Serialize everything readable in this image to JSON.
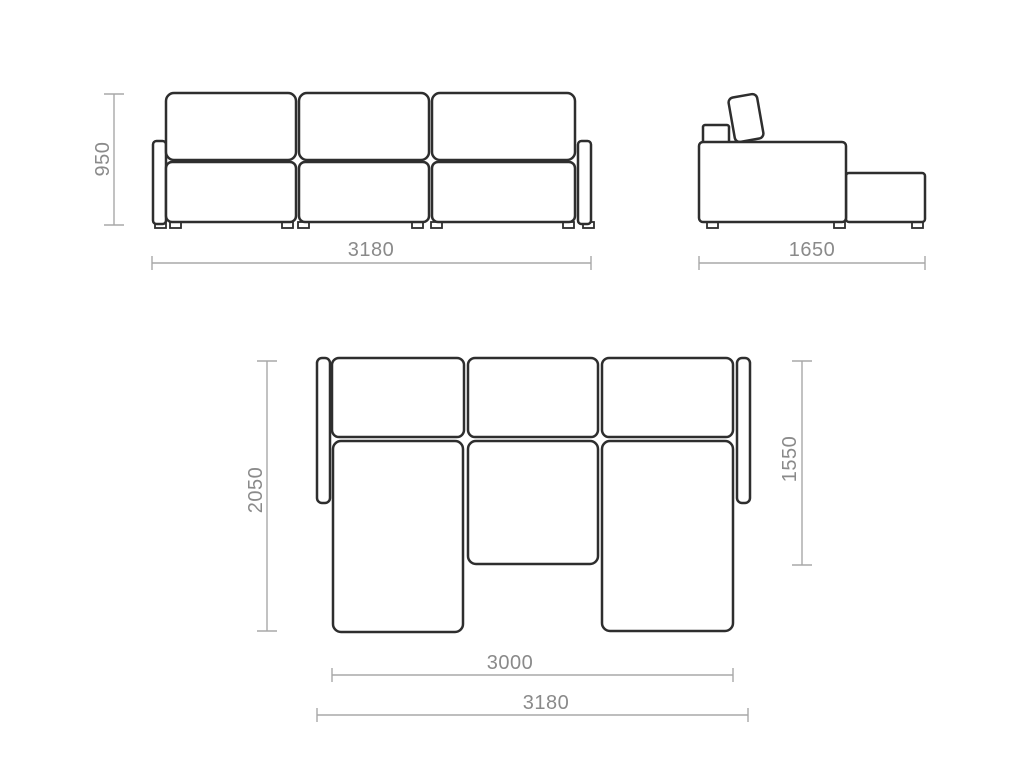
{
  "drawing": {
    "background_color": "#ffffff",
    "outline_color": "#2e2e2e",
    "dimension_line_color": "#a8a8a8",
    "dimension_text_color": "#8a8a8a",
    "views": {
      "front": {
        "height": "950",
        "overall_width": "3180"
      },
      "side": {
        "overall_depth": "1650"
      },
      "plan": {
        "overall_depth": "2050",
        "chaise_depth": "1550",
        "bed_width": "3000",
        "overall_width": "3180"
      }
    }
  }
}
